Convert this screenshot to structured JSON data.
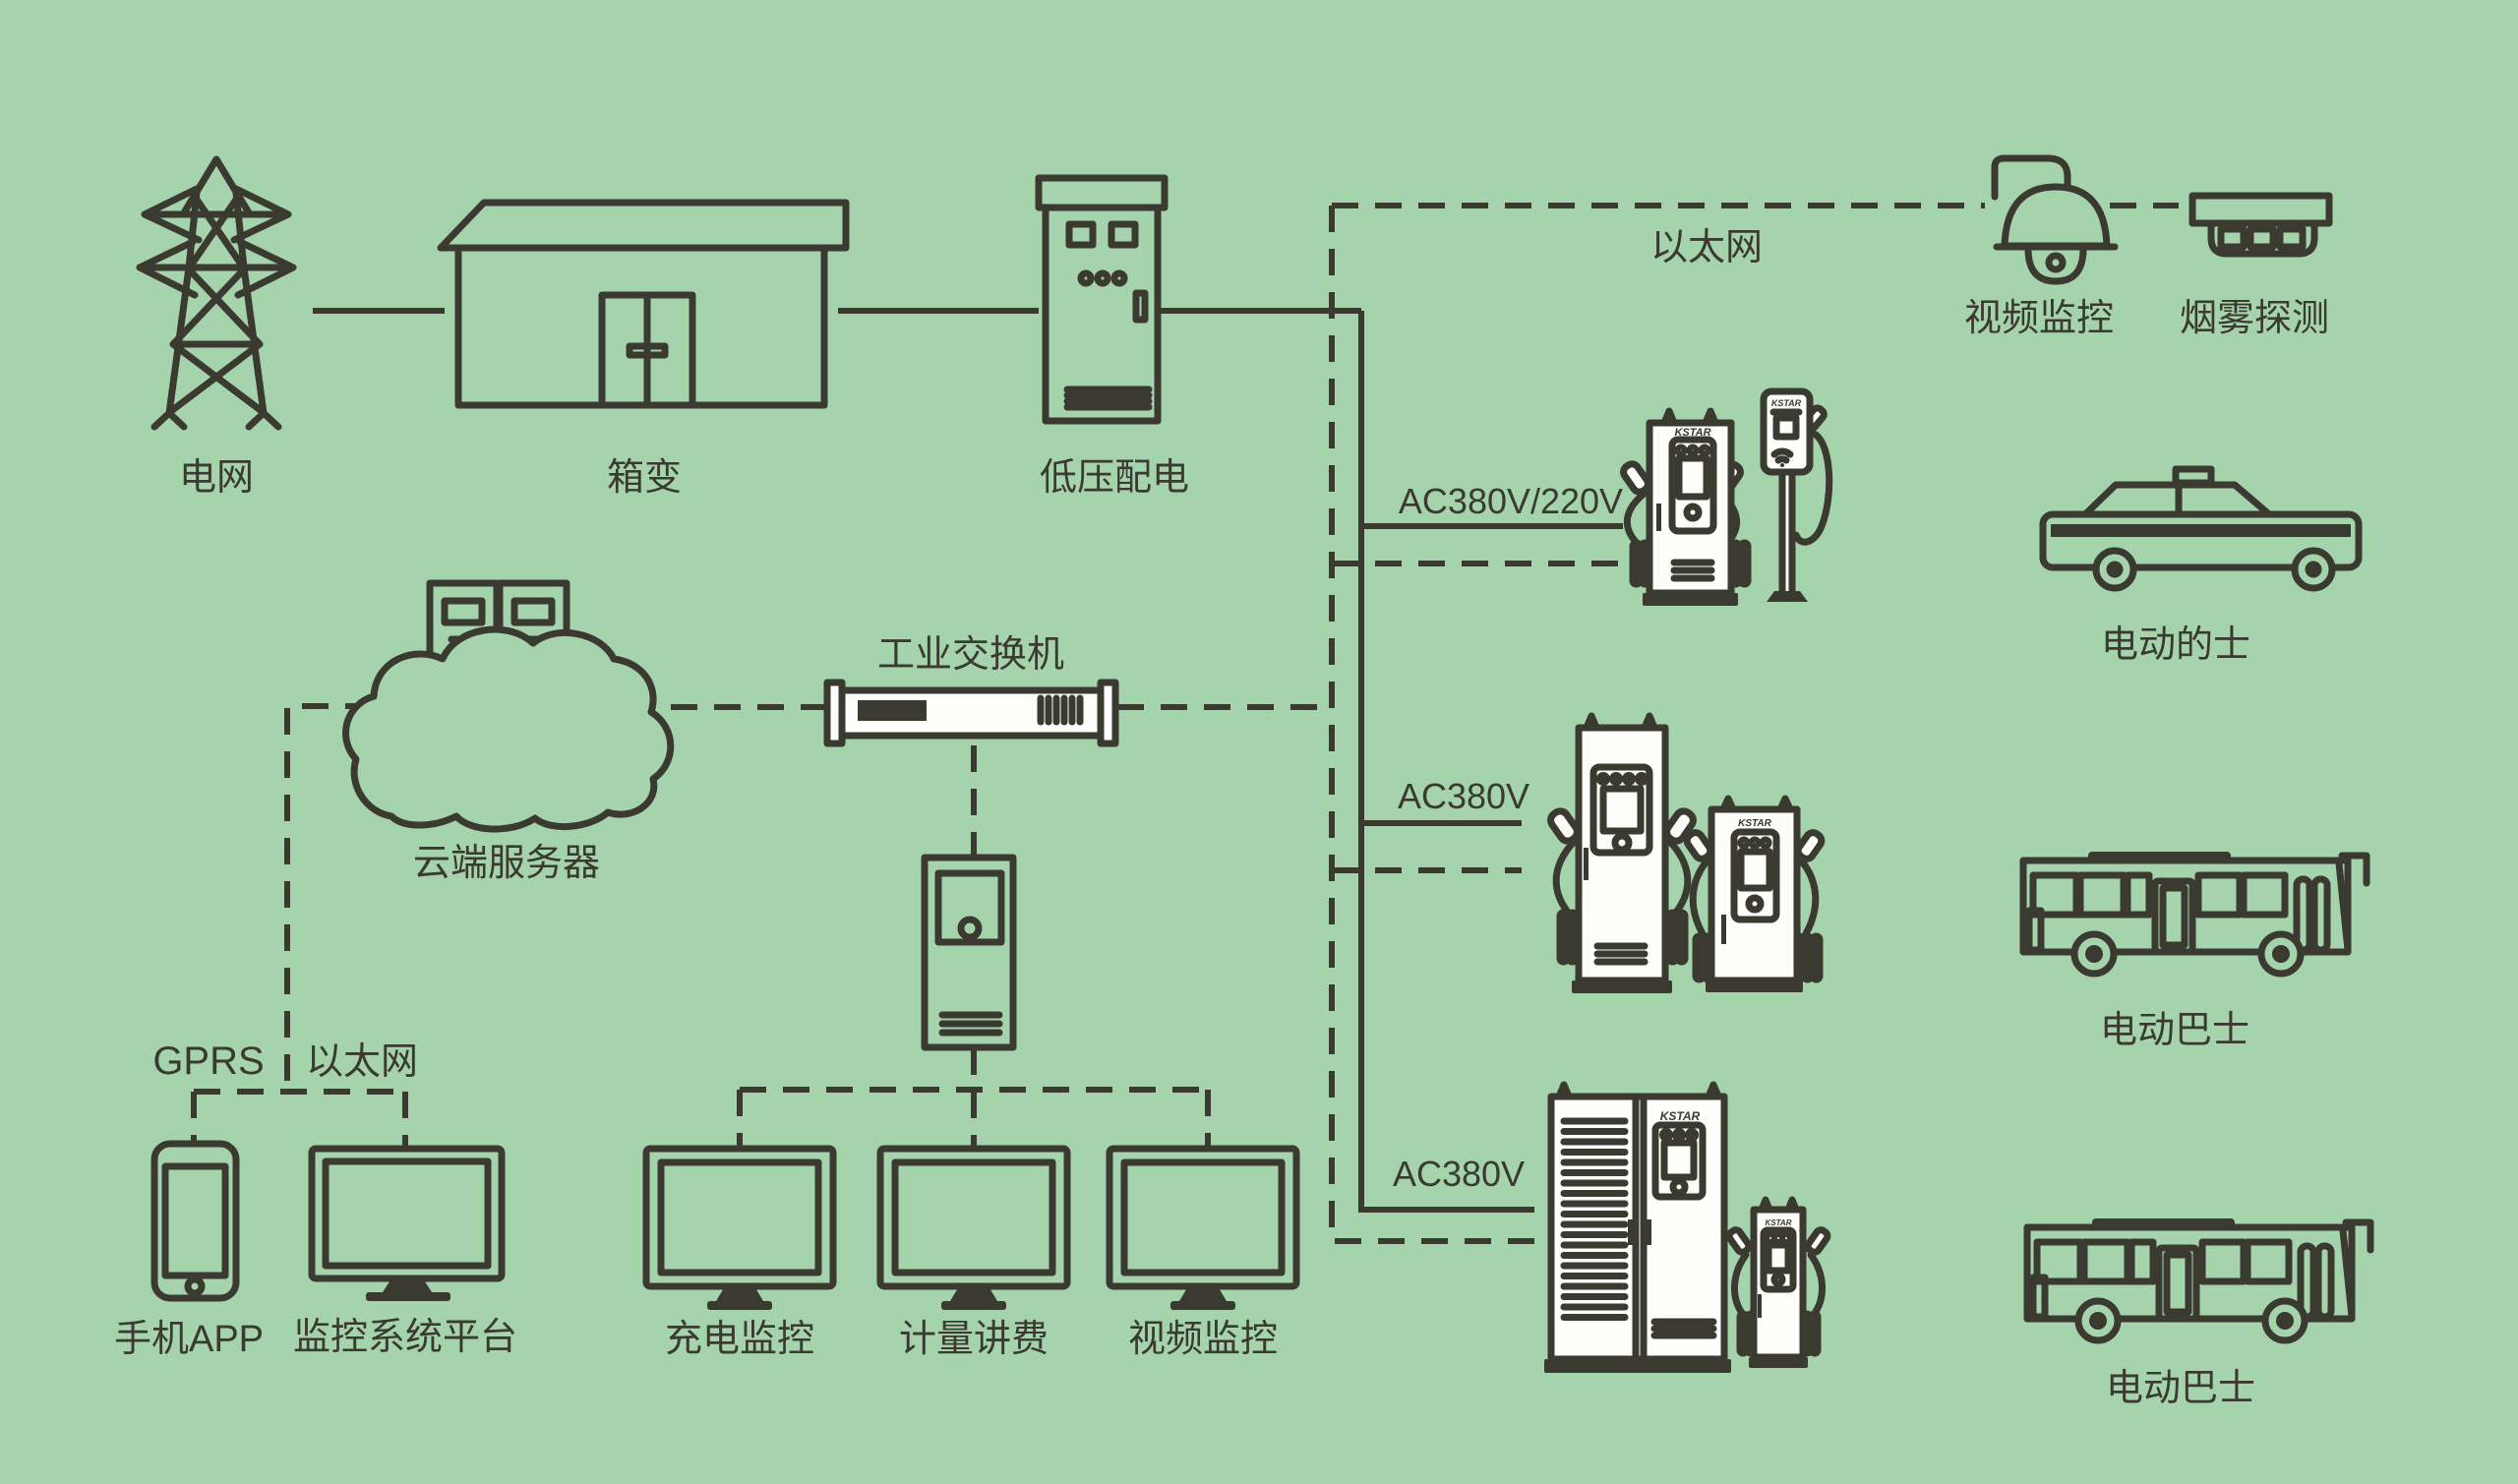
{
  "colors": {
    "background": "#a5d3ac",
    "line": "#3a3a31",
    "device_fill": "#fdfdfa"
  },
  "brand": "KSTAR",
  "power_chain": {
    "grid": "电网",
    "transformer": "箱变",
    "lv_distribution": "低压配电"
  },
  "network": {
    "ethernet_trunk": "以太网",
    "video_surveillance": "视频监控",
    "smoke_detection": "烟雾探测",
    "cloud_server": "云端服务器",
    "industrial_switch": "工业交换机",
    "gprs": "GPRS",
    "ethernet_lan": "以太网"
  },
  "clients": {
    "mobile_app": "手机APP",
    "monitoring_platform": "监控系统平台",
    "charging_monitor": "充电监控",
    "metering_billing": "计量讲费",
    "video_monitor": "视频监控"
  },
  "charging_zones": [
    {
      "voltage": "AC380V/220V",
      "vehicle": "电动的士"
    },
    {
      "voltage": "AC380V",
      "vehicle": "电动巴士"
    },
    {
      "voltage": "AC380V",
      "vehicle": "电动巴士"
    }
  ]
}
